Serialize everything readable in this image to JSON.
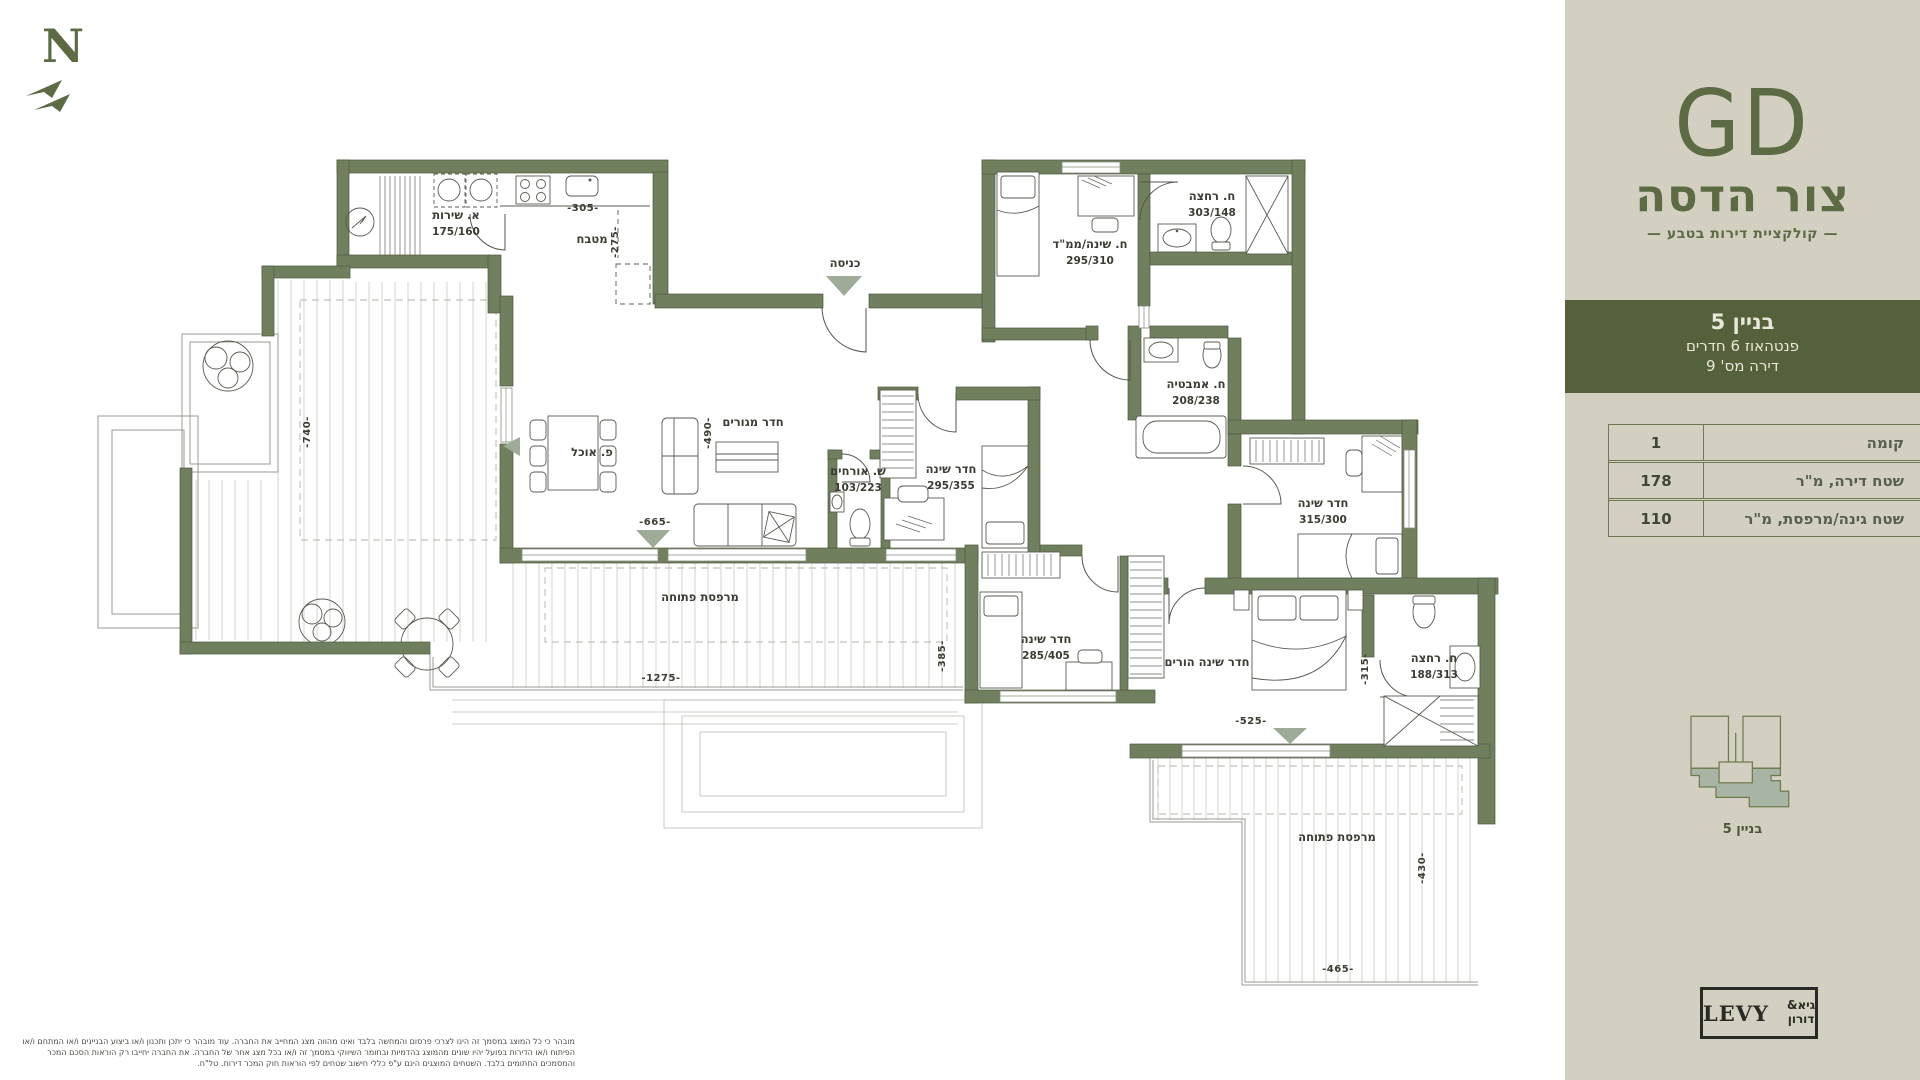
{
  "north": {
    "label": "N"
  },
  "sidebar": {
    "bg": "#d3d0c2",
    "accent": "#5c6b44",
    "logo": {
      "monogram": "GD",
      "project": "צור הדסה",
      "tagline": "— קולקציית דירות בטבע —"
    },
    "banner": {
      "bg": "#55613b",
      "building": "בניין 5",
      "apartment_type": "פנטהאוז 6 חדרים",
      "apartment_no": "דירה מס' 9"
    },
    "table": {
      "rows": [
        {
          "label": "קומה",
          "value": "1"
        },
        {
          "label": "שטח דירה, מ\"ר",
          "value": "178"
        },
        {
          "label": "שטח גינה/מרפסת, מ\"ר",
          "value": "110"
        }
      ]
    },
    "footprint": {
      "caption": "בניין 5"
    },
    "developer": {
      "latin": "LEVY",
      "hebrew_top": "גיא&",
      "hebrew_bottom": "דורון"
    }
  },
  "plan": {
    "wall_color": "#70805f",
    "triangle_color": "#9dab97",
    "rooms": [
      {
        "label": "א. שירות",
        "dims": "175/160",
        "x": 456,
        "y": 219
      },
      {
        "label": "מטבח",
        "dims": "",
        "x": 592,
        "y": 243
      },
      {
        "label": "כניסה",
        "dims": "",
        "x": 845,
        "y": 267
      },
      {
        "label": "ח. שינה/ממ\"ד",
        "dims": "295/310",
        "x": 1090,
        "y": 248
      },
      {
        "label": "ח. רחצה",
        "dims": "303/148",
        "x": 1212,
        "y": 200
      },
      {
        "label": "ח. אמבטיה",
        "dims": "208/238",
        "x": 1196,
        "y": 388
      },
      {
        "label": "חדר מגורים",
        "dims": "",
        "x": 753,
        "y": 426
      },
      {
        "label": "פ. אוכל",
        "dims": "",
        "x": 592,
        "y": 456
      },
      {
        "label": "ש. אורחים",
        "dims": "103/223",
        "x": 858,
        "y": 475
      },
      {
        "label": "חדר שינה",
        "dims": "295/355",
        "x": 951,
        "y": 473
      },
      {
        "label": "חדר שינה",
        "dims": "315/300",
        "x": 1323,
        "y": 507
      },
      {
        "label": "חדר שינה",
        "dims": "285/405",
        "x": 1046,
        "y": 643
      },
      {
        "label": "חדר שינה הורים",
        "dims": "",
        "x": 1207,
        "y": 666
      },
      {
        "label": "ח. רחצה",
        "dims": "188/313",
        "x": 1434,
        "y": 662
      },
      {
        "label": "מרפסת פתוחה",
        "dims": "",
        "x": 700,
        "y": 601
      },
      {
        "label": "מרפסת פתוחה",
        "dims": "",
        "x": 1337,
        "y": 841
      }
    ],
    "dimensions": [
      {
        "text": "-305-",
        "x": 583,
        "y": 211,
        "vertical": false
      },
      {
        "text": "-275-",
        "x": 618,
        "y": 242,
        "vertical": true
      },
      {
        "text": "-490-",
        "x": 711,
        "y": 433,
        "vertical": true
      },
      {
        "text": "-665-",
        "x": 655,
        "y": 525,
        "vertical": false
      },
      {
        "text": "-740-",
        "x": 310,
        "y": 432,
        "vertical": true
      },
      {
        "text": "-1275-",
        "x": 661,
        "y": 681,
        "vertical": false
      },
      {
        "text": "-385-",
        "x": 945,
        "y": 656,
        "vertical": true
      },
      {
        "text": "-525-",
        "x": 1251,
        "y": 724,
        "vertical": false
      },
      {
        "text": "-315-",
        "x": 1368,
        "y": 669,
        "vertical": true
      },
      {
        "text": "-430-",
        "x": 1425,
        "y": 868,
        "vertical": true
      },
      {
        "text": "-465-",
        "x": 1338,
        "y": 972,
        "vertical": false
      }
    ],
    "disclaimer": "מובהר כי כל המוצג במסמך זה הינו לצרכי פרסום והמחשה בלבד ואינו מהווה מצג המחייב את החברה. עוד מובהר כי יתכן ותכנון ו/או ביצוע הבניינים ו/או המתחם ו/או הפיתוח ו/או הדירות בפועל יהיו שונים מהמוצג בהדמיות ובחומר השיווקי במסמך זה ו/או בכל מצג אחר של החברה. את החברה יחייבו רק הוראות הסכם המכר והמסמכים החתומים בלבד. השטחים המוצגים הינם ע\"פ כללי חישוב שטחים לפי הוראות חוק המכר דירות. טל\"ח."
  }
}
